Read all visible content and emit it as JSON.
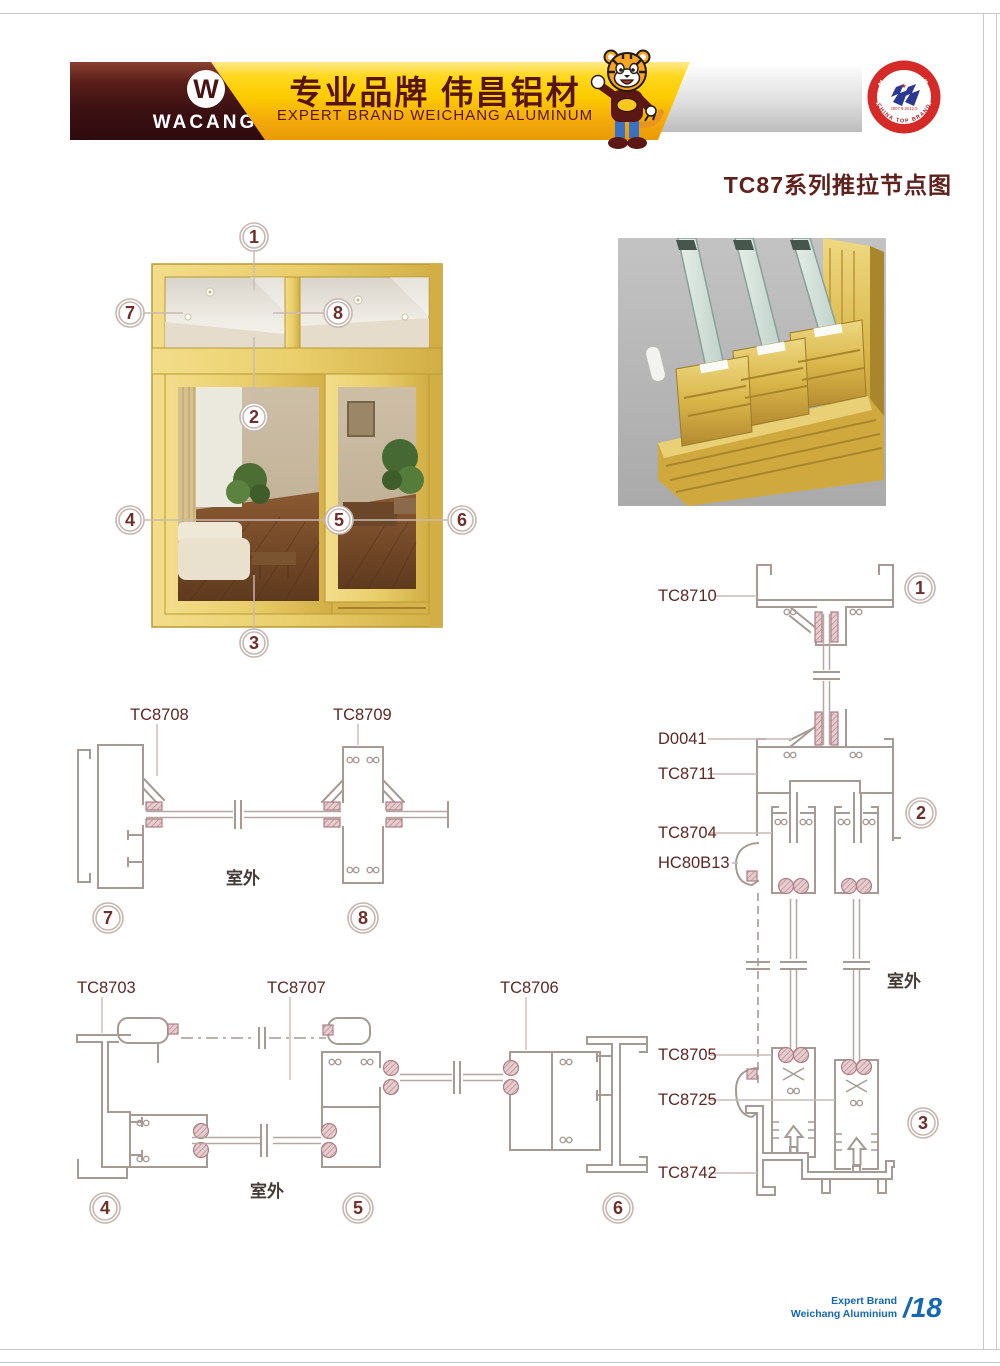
{
  "header": {
    "logo": {
      "brand": "WACANG",
      "registered": "®"
    },
    "banner": {
      "title_cn": "专业品牌  伟昌铝材",
      "subtitle_en": "EXPERT BRAND WEICHANG ALUMINUM"
    },
    "honors": {
      "line1": "中国驰名商标",
      "line2": "中国名牌产品"
    },
    "badge": {
      "arc_top": "中国名牌",
      "arc_bottom": "CHINA TOP BRAND",
      "years": "2007.9-2012.9",
      "star": "★"
    },
    "mascot_icon": "tiger-mascot"
  },
  "page_title": "TC87系列推拉节点图",
  "window_figure": {
    "callouts": [
      "1",
      "2",
      "3",
      "4",
      "5",
      "6",
      "7",
      "8"
    ]
  },
  "details": {
    "vertical_section": {
      "labels": [
        "TC8710",
        "D0041",
        "TC8711",
        "TC8704",
        "HC80B13",
        "TC8705",
        "TC8725",
        "TC8742"
      ],
      "outdoor": "室外",
      "callouts": [
        "1",
        "2",
        "3"
      ]
    },
    "section_78": {
      "labels": [
        "TC8708",
        "TC8709"
      ],
      "outdoor": "室外",
      "callouts": [
        "7",
        "8"
      ]
    },
    "section_456": {
      "labels": [
        "TC8703",
        "TC8707",
        "TC8706"
      ],
      "outdoor": "室外",
      "callouts": [
        "4",
        "5",
        "6"
      ]
    }
  },
  "footer": {
    "brand_line1": "Expert Brand",
    "brand_line2": "Weichang Aluminium",
    "page_number": "/18"
  },
  "colors": {
    "accent_maroon": "#5e211c",
    "banner_yellow": "#fccb00",
    "brand_dark_red": "#3c1113",
    "honor_blue": "#2e75b6",
    "footer_blue": "#1567b2",
    "badge_red": "#d42a28",
    "window_gold": "#e9ce6a",
    "drawing_line": "#a59a94",
    "gasket_pink": "#d5aeb2"
  }
}
